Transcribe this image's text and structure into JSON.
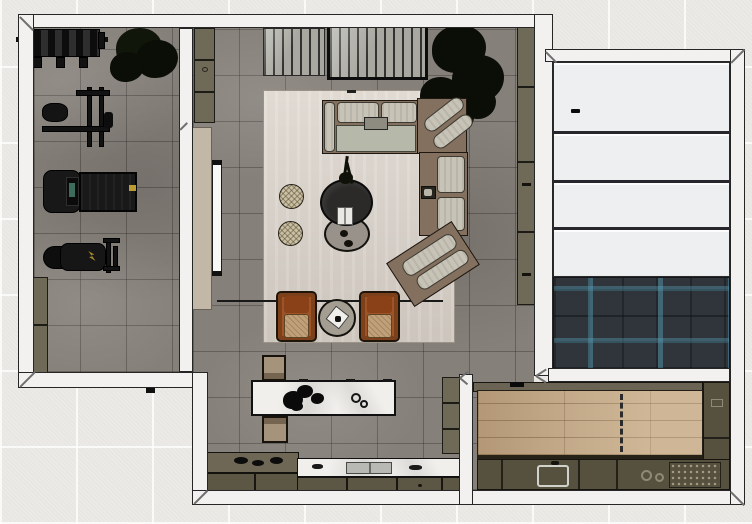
{
  "scene": {
    "type": "3d-floor-plan-render",
    "description": "Top-down rendered floor plan with home gym, living room with corner sectional, kitchen with marble island, paneled area over dark teal herringbone tile, and a utility room with light wood plank floor",
    "rooms": [
      {
        "id": "gym",
        "floor": "gray-stone-tile"
      },
      {
        "id": "living-room",
        "floor": "gray-stone-tile",
        "rug": "light-beige-area-rug"
      },
      {
        "id": "kitchen",
        "floor": "gray-stone-tile"
      },
      {
        "id": "panel-room",
        "floor": "white-horizontal-panels",
        "panel_count": 4
      },
      {
        "id": "herringbone-room",
        "floor": "dark-teal-herringbone-tile"
      },
      {
        "id": "utility-room",
        "floor": "light-oak-plank"
      }
    ],
    "furniture": {
      "gym": [
        "barbell-rack",
        "potted-plant",
        "cable-machine",
        "treadmill",
        "weight-bench",
        "low-cabinet"
      ],
      "living": [
        "slatted-sideboard",
        "framed-slatted-sideboard",
        "indoor-tree",
        "corner-sectional-sofa",
        "pouf",
        "pouf",
        "round-coffee-table-dark",
        "round-coffee-table-gray",
        "armchair",
        "armchair",
        "round-side-table",
        "tall-wall-cabinet",
        "sliding-door"
      ],
      "kitchen": [
        "marble-island",
        "island-bench",
        "island-bench",
        "cooktop-counter",
        "marble-sink-counter",
        "counter-cabinet"
      ],
      "utility": [
        "counter-run",
        "sink-unit",
        "burner-unit",
        "side-cabinet-column"
      ]
    },
    "colors": {
      "background_tile": "#eceae6",
      "wall_fill": "#f2f1ef",
      "wall_line": "#262626",
      "floor_gray": "#86807a",
      "rug": "#d8d0c7",
      "cabinet_olive": "#6f6958",
      "counter_dark_olive": "#56503e",
      "sofa_brown": "#84705e",
      "cushion_gray": "#c7c3b6",
      "armchair_rust": "#9e5426",
      "armchair_seat_tan": "#c0a078",
      "pouf_tan": "#c9bfa3",
      "island_marble": "#f1efec",
      "herringbone_base": "#2f353b",
      "herringbone_accent": "#5aa0b9",
      "wood_floor": "#c0a685",
      "door_panel_beige": "#c3b7a7",
      "equipment_black": "#141414",
      "accent_yellow": "#bb9c33"
    }
  }
}
